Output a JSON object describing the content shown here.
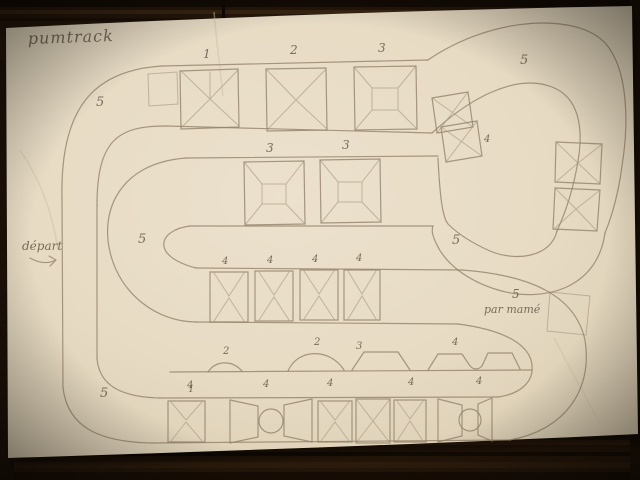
{
  "photo": {
    "paper_color": "#e9ddc6",
    "wood_color": "#241609",
    "pencil_color": "#93826c"
  },
  "title": "pumtrack",
  "annotations": {
    "depart": "départ",
    "credit_number": "5",
    "credit": "par mamé"
  },
  "module_labels": {
    "top": [
      "1",
      "2",
      "3"
    ],
    "middle": [
      "3",
      "3"
    ],
    "rollers": [
      "4",
      "4",
      "4",
      "4"
    ],
    "connector": "4",
    "bottom": "1"
  },
  "curve_labels": {
    "top_left": "5",
    "top_right": "5",
    "mid_left": "5",
    "mid_right": "5",
    "bottom_left": "5"
  },
  "profile_legend": {
    "above": [
      "2",
      "2",
      "3",
      "4"
    ],
    "below": [
      "4",
      "4",
      "4",
      "4",
      "4"
    ]
  }
}
